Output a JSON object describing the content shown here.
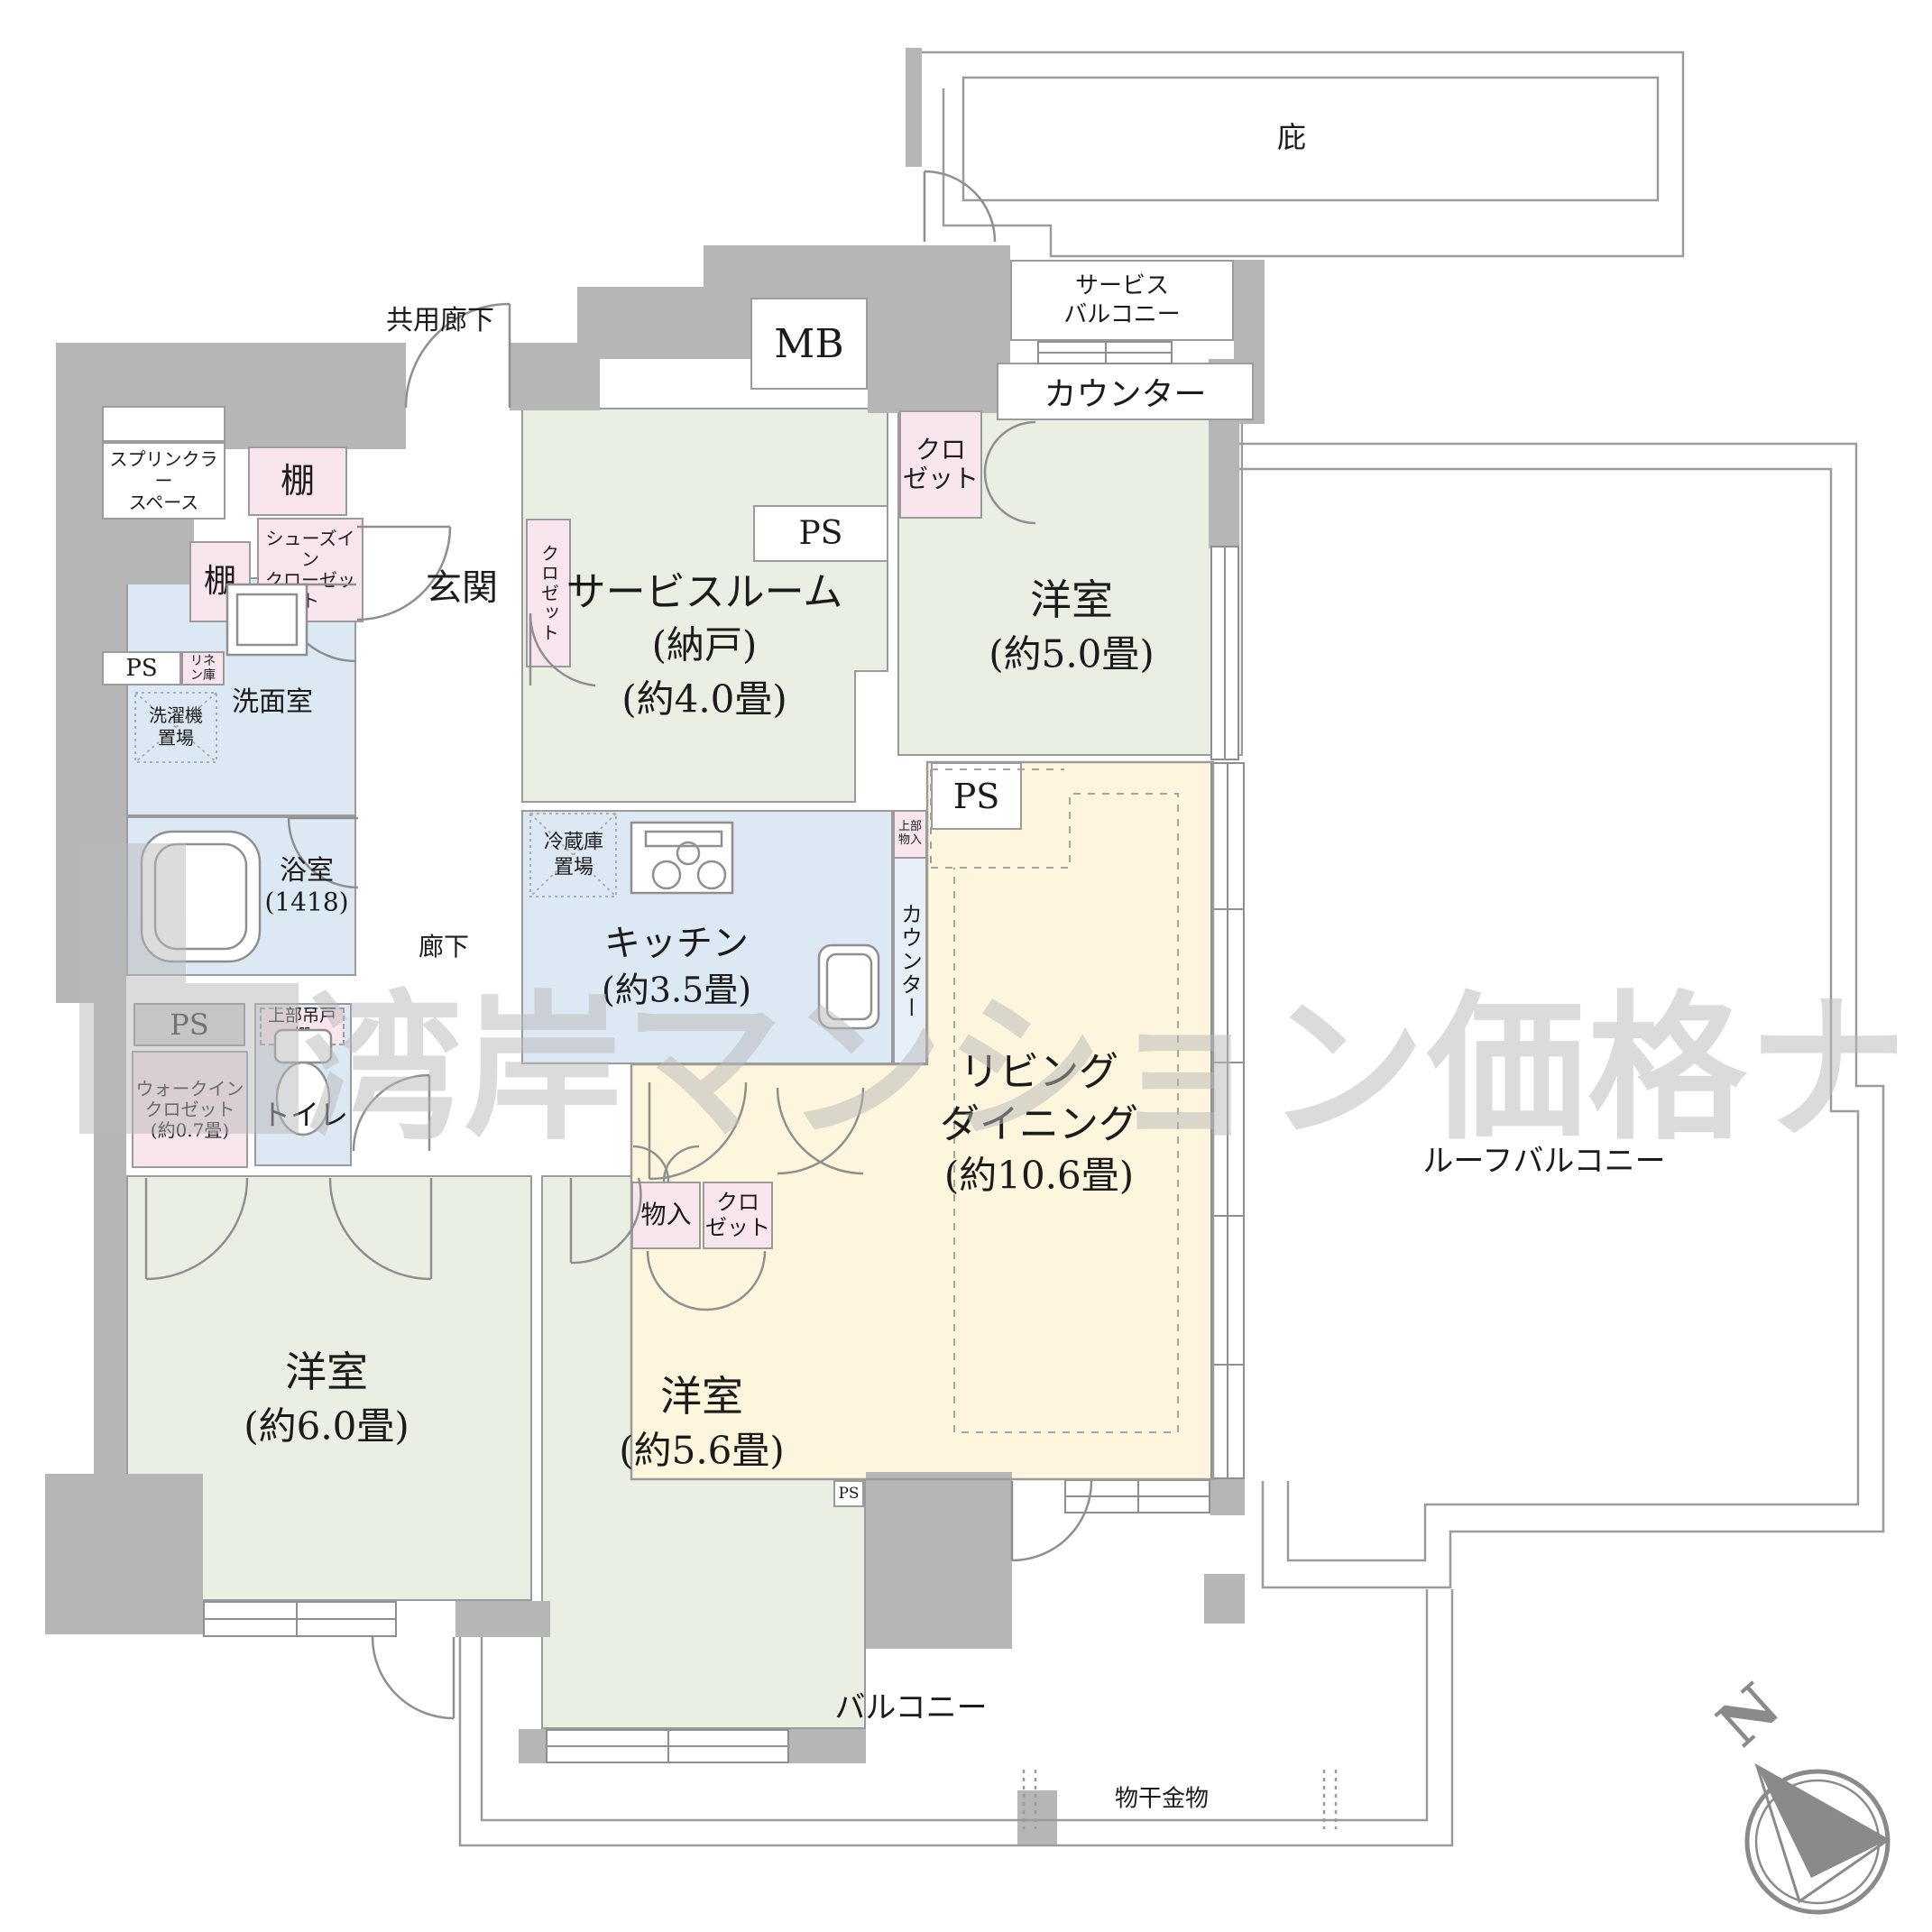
{
  "watermark": {
    "text": "湾岸マンション価格ナビ"
  },
  "compass": {
    "north": "N"
  },
  "outdoor": {
    "hisashi": "庇",
    "service_balcony1": "サービス",
    "service_balcony2": "バルコニー",
    "counter": "カウンター",
    "common_corridor": "共用廊下",
    "roof_balcony": "ルーフバルコニー",
    "balcony": "バルコニー",
    "monohoshi": "物干金物"
  },
  "rooms": {
    "bed5": {
      "name": "洋室",
      "size": "(約5.0畳)"
    },
    "bed6": {
      "name": "洋室",
      "size": "(約6.0畳)"
    },
    "bed56": {
      "name": "洋室",
      "size": "(約5.6畳)"
    },
    "service_room": {
      "name": "サービスルーム",
      "sub": "(納戸)",
      "size": "(約4.0畳)"
    },
    "ld": {
      "line1": "リビング",
      "line2": "ダイニング",
      "size": "(約10.6畳)"
    },
    "kitchen": {
      "name": "キッチン",
      "size": "(約3.5畳)",
      "counter": "カウンター",
      "fridge1": "冷蔵庫",
      "fridge2": "置場",
      "upper1": "上部",
      "upper2": "物入"
    },
    "washroom": {
      "name": "洗面室",
      "washer1": "洗濯機",
      "washer2": "置場",
      "linen1": "リネ",
      "linen2": "ン庫"
    },
    "bath": {
      "name": "浴室",
      "size": "(1418)"
    },
    "toilet": {
      "name": "トイレ",
      "upper_cabinet": "上部吊戸棚"
    },
    "entrance": {
      "name": "玄関",
      "shoes1": "シューズイン",
      "shoes2": "クローゼット",
      "shelf": "棚",
      "sprinkler1": "スプリンクラー",
      "sprinkler2": "スペース"
    },
    "hallway": {
      "name": "廊下"
    },
    "wic": {
      "line1": "ウォークイン",
      "line2": "クロゼット",
      "line3": "(約0.7畳)"
    },
    "storage": {
      "monoire": "物入",
      "closet1": "クロ",
      "closet2": "ゼット",
      "closet_v": "クロゼット"
    },
    "utility": {
      "mb": "MB",
      "ps": "PS"
    }
  }
}
